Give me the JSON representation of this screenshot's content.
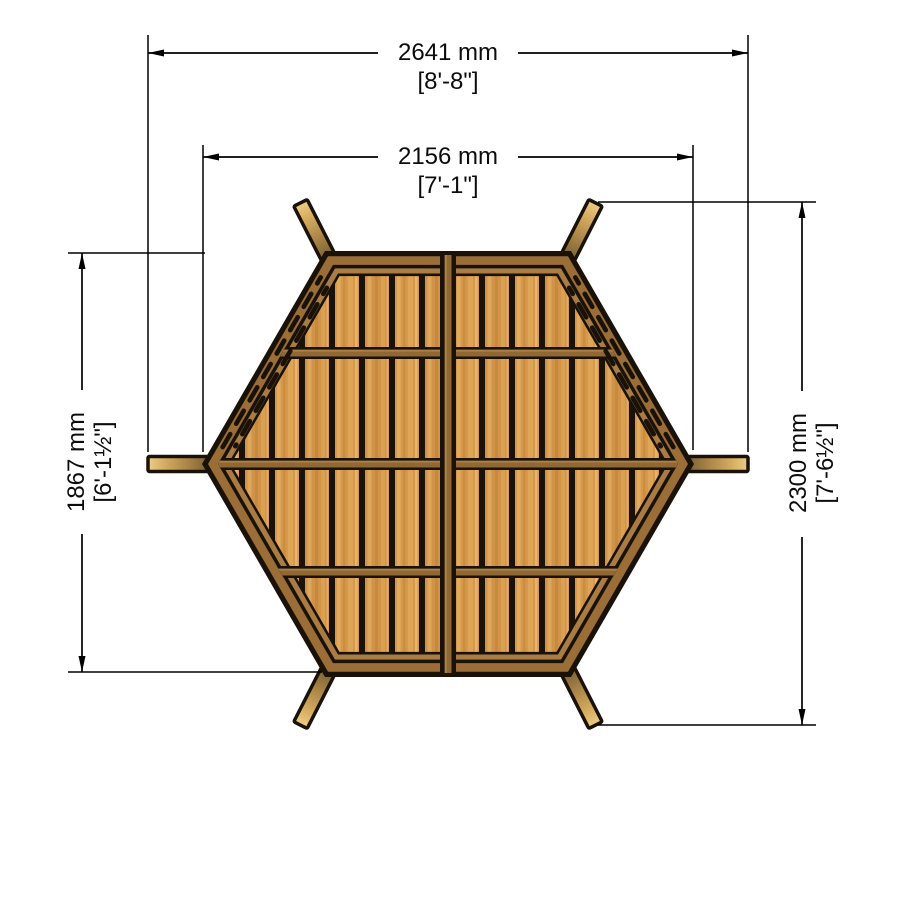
{
  "drawing": {
    "title": "Hexagonal summerhouse floor base - plan view",
    "dimensions": {
      "overall_width": {
        "metric": "2641 mm",
        "imperial": "[8'-8\"]"
      },
      "deck_width": {
        "metric": "2156 mm",
        "imperial": "[7'-1\"]"
      },
      "deck_height": {
        "metric": "1867 mm",
        "imperial": "[6'-1½\"]"
      },
      "overall_height": {
        "metric": "2300 mm",
        "imperial": "[7'-6½\"]"
      }
    },
    "colors": {
      "outline": "#1A1208",
      "rim": "#9A6E36",
      "rim_inner": "#A87C42",
      "plank": "#D6994B",
      "plank_alt": "#D09348",
      "rail": "#8F6833",
      "beam_base": "#6E5930",
      "beam_tip": "#EECE84",
      "dimension": "#000000",
      "background": "#FFFFFF"
    }
  }
}
